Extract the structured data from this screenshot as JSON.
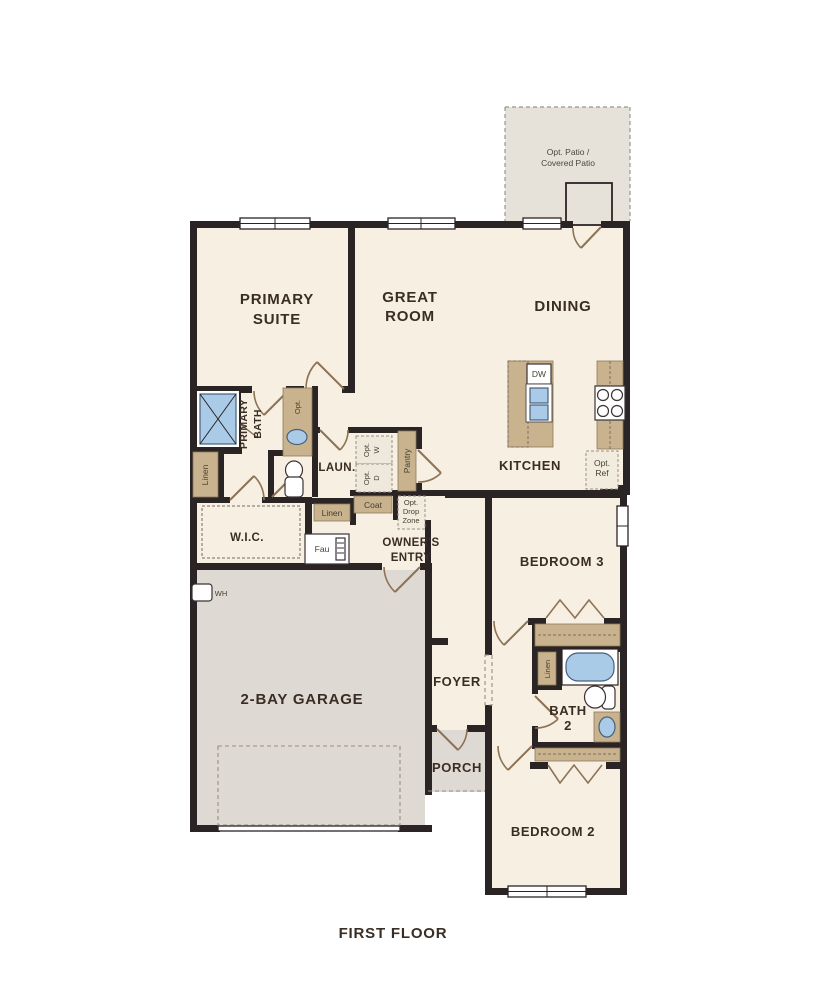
{
  "plan": {
    "title": "FIRST FLOOR",
    "rooms": {
      "patio": {
        "line1": "Opt. Patio /",
        "line2": "Covered Patio"
      },
      "primary_suite": {
        "line1": "PRIMARY",
        "line2": "SUITE"
      },
      "great_room": {
        "line1": "GREAT",
        "line2": "ROOM"
      },
      "dining": {
        "label": "DINING"
      },
      "kitchen": {
        "label": "KITCHEN"
      },
      "primary_bath": {
        "line1": "PRIMARY",
        "line2": "BATH"
      },
      "laundry": {
        "label": "LAUN."
      },
      "wic": {
        "label": "W.I.C."
      },
      "owners_entry": {
        "line1": "OWNER'S",
        "line2": "ENTRY"
      },
      "garage": {
        "label": "2-BAY GARAGE"
      },
      "foyer": {
        "label": "FOYER"
      },
      "porch": {
        "label": "PORCH"
      },
      "bedroom3": {
        "label": "BEDROOM 3"
      },
      "bath2": {
        "line1": "BATH",
        "line2": "2"
      },
      "bedroom2": {
        "label": "BEDROOM 2"
      }
    },
    "features": {
      "dishwasher": "DW",
      "opt_ref": {
        "line1": "Opt.",
        "line2": "Ref"
      },
      "opt_washer": {
        "line1": "Opt.",
        "line2": "W"
      },
      "opt_dryer": {
        "line1": "Opt.",
        "line2": "D"
      },
      "pantry": "Pantry",
      "coat": "Coat",
      "drop_zone": {
        "line1": "Opt.",
        "line2": "Drop",
        "line3": "Zone"
      },
      "linen_primary": "Linen",
      "linen_hall": "Linen",
      "linen_bath2": "Linen",
      "opt_vanity": "Opt.",
      "furnace": "Fau",
      "water_heater": "WH"
    },
    "colors": {
      "floor": "#f7efe1",
      "hard_floor": "#dedad3",
      "patio_floor": "#e6e1d9",
      "wall": "#2b2425",
      "cabinet": "#c9b28e",
      "fixture_blue": "#aacbe8",
      "door": "#8d7355",
      "text": "#3a2d24"
    }
  }
}
